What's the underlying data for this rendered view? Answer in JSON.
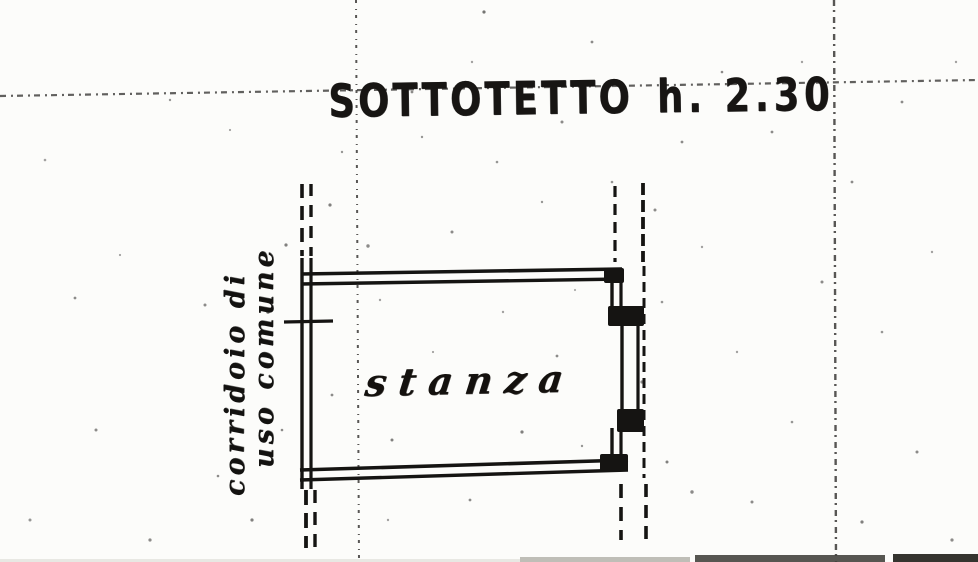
{
  "plan": {
    "title": {
      "text": "SOTTOTETTO",
      "height": "h. 2.30"
    },
    "room_label": "stanza",
    "corridor_label": {
      "line1": "corridoio di",
      "line2": "uso comune"
    },
    "colors": {
      "ink": "#151412",
      "paper": "#fcfcfa",
      "fold_line": "#2e2c2a",
      "scan_band_dark": "#35342f",
      "scan_band_mid": "#45443e",
      "scan_band_light": "#8c8a80"
    }
  }
}
